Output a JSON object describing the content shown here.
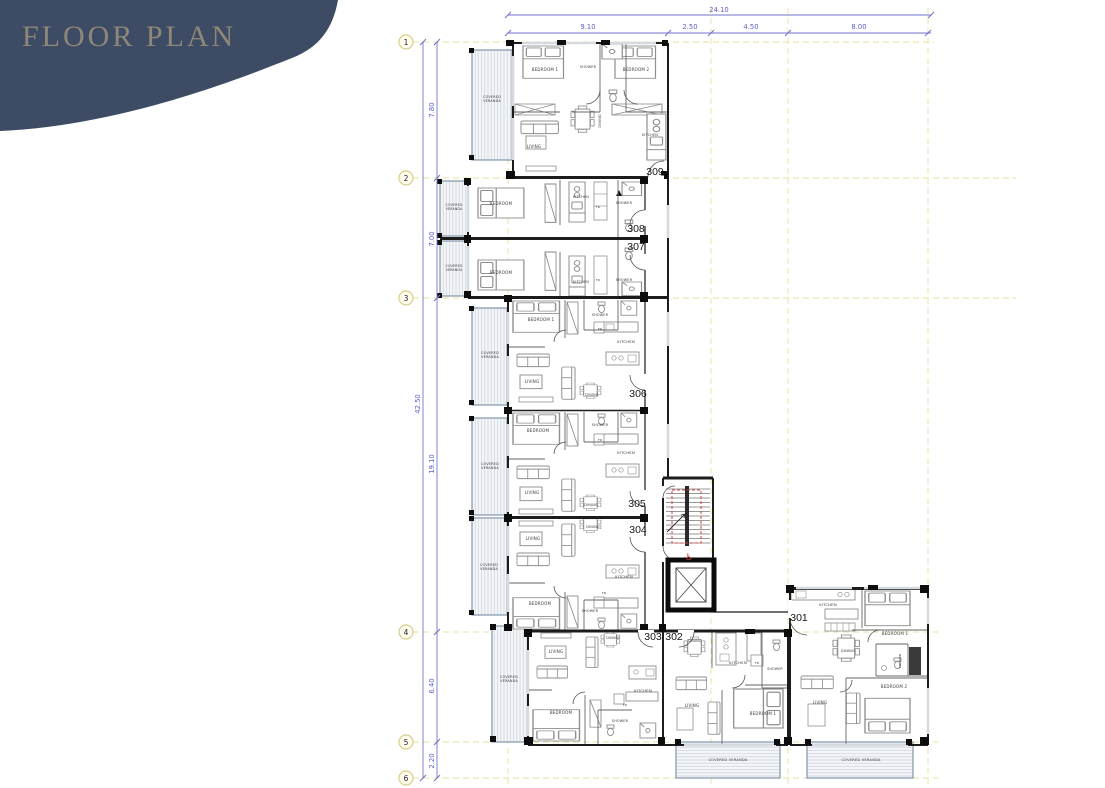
{
  "title": "FLOOR PLAN",
  "colors": {
    "blob": "#3d4c64",
    "title_text": "#8e8779",
    "dimension": "#6a6ac8",
    "grid": "#e7e39b",
    "wall": "#1c1c1c",
    "red_accent": "#c0392b",
    "veranda_border": "#8195aa"
  },
  "plan": {
    "grid_bubbles": [
      {
        "n": "1",
        "y": 42
      },
      {
        "n": "2",
        "y": 178
      },
      {
        "n": "3",
        "y": 298
      },
      {
        "n": "4",
        "y": 632
      },
      {
        "n": "5",
        "y": 742
      },
      {
        "n": "6",
        "y": 778
      }
    ],
    "dim_labels": [
      {
        "t": "24.10",
        "x": 719,
        "y": 12
      },
      {
        "t": "9.10",
        "x": 588,
        "y": 29
      },
      {
        "t": "2.50",
        "x": 690,
        "y": 29
      },
      {
        "t": "4.50",
        "x": 751,
        "y": 29
      },
      {
        "t": "8.00",
        "x": 859,
        "y": 29
      },
      {
        "t": "42.50",
        "x": 420,
        "y": 404,
        "r": -90
      },
      {
        "t": "7.80",
        "x": 434,
        "y": 110,
        "r": -90
      },
      {
        "t": "7.00",
        "x": 434,
        "y": 239,
        "r": -90
      },
      {
        "t": "19.10",
        "x": 434,
        "y": 464,
        "r": -90
      },
      {
        "t": "6.40",
        "x": 434,
        "y": 686,
        "r": -90
      },
      {
        "t": "2.20",
        "x": 434,
        "y": 761,
        "r": -90
      }
    ],
    "unit_numbers": [
      {
        "n": "309",
        "x": 655,
        "y": 175
      },
      {
        "n": "308",
        "x": 636,
        "y": 232
      },
      {
        "n": "307",
        "x": 636,
        "y": 250
      },
      {
        "n": "306",
        "x": 638,
        "y": 397
      },
      {
        "n": "305",
        "x": 637,
        "y": 507
      },
      {
        "n": "304",
        "x": 638,
        "y": 533
      },
      {
        "n": "303",
        "x": 653,
        "y": 640
      },
      {
        "n": "302",
        "x": 674,
        "y": 640
      },
      {
        "n": "301",
        "x": 799,
        "y": 621
      }
    ],
    "room_labels": [
      {
        "t": "BEDROOM 1",
        "x": 545,
        "y": 71
      },
      {
        "t": "SHOWER",
        "x": 588,
        "y": 68,
        "s": 3.4
      },
      {
        "t": "BEDROOM 2",
        "x": 636,
        "y": 71
      },
      {
        "t": "COVERED",
        "t2": "VERANDA",
        "x": 492,
        "y": 98,
        "s": 3.4
      },
      {
        "t": "DINING",
        "x": 601,
        "y": 121,
        "r": -90,
        "s": 3.4
      },
      {
        "t": "LIVING",
        "x": 534,
        "y": 148
      },
      {
        "t": "KITCHEN",
        "x": 650,
        "y": 136,
        "s": 3.4
      },
      {
        "t": "COVERED",
        "t2": "VERANDA",
        "x": 454,
        "y": 206,
        "s": 3.2
      },
      {
        "t": "BEDROOM",
        "x": 501,
        "y": 205
      },
      {
        "t": "KITCHEN",
        "x": 581,
        "y": 198,
        "s": 3.4
      },
      {
        "t": "FR",
        "x": 598,
        "y": 208,
        "s": 3
      },
      {
        "t": "SHOWER",
        "x": 624,
        "y": 204,
        "s": 3.4
      },
      {
        "t": "COVERED",
        "t2": "VERANDA",
        "x": 454,
        "y": 267,
        "s": 3.2
      },
      {
        "t": "BEDROOM",
        "x": 501,
        "y": 274
      },
      {
        "t": "KITCHEN",
        "x": 581,
        "y": 283,
        "s": 3.4
      },
      {
        "t": "FR",
        "x": 598,
        "y": 281,
        "s": 3
      },
      {
        "t": "SHOWER",
        "x": 624,
        "y": 281,
        "s": 3.4
      },
      {
        "t": "COVERED",
        "t2": "VERANDA",
        "x": 490,
        "y": 354,
        "s": 3.4
      },
      {
        "t": "BEDROOM 1",
        "x": 541,
        "y": 321
      },
      {
        "t": "SHOWER",
        "x": 600,
        "y": 316,
        "s": 3.4
      },
      {
        "t": "FR",
        "x": 600,
        "y": 330,
        "s": 3
      },
      {
        "t": "KITCHEN",
        "x": 626,
        "y": 343,
        "s": 3.8
      },
      {
        "t": "LIVING",
        "x": 532,
        "y": 383
      },
      {
        "t": "DINING",
        "x": 592,
        "y": 396,
        "s": 3.4
      },
      {
        "t": "COVERED",
        "t2": "VERANDA",
        "x": 490,
        "y": 465,
        "s": 3.4
      },
      {
        "t": "BEDROOM",
        "x": 538,
        "y": 432
      },
      {
        "t": "SHOWER",
        "x": 600,
        "y": 426,
        "s": 3.4
      },
      {
        "t": "FR",
        "x": 600,
        "y": 441,
        "s": 3
      },
      {
        "t": "KITCHEN",
        "x": 626,
        "y": 454,
        "s": 3.8
      },
      {
        "t": "LIVING",
        "x": 532,
        "y": 494
      },
      {
        "t": "DINING",
        "x": 591,
        "y": 506,
        "s": 3.4
      },
      {
        "t": "COVERED",
        "t2": "VERANDA",
        "x": 489,
        "y": 566,
        "s": 3.4
      },
      {
        "t": "DINING",
        "x": 593,
        "y": 528,
        "s": 3.4
      },
      {
        "t": "LIVING",
        "x": 533,
        "y": 540
      },
      {
        "t": "KITCHEN",
        "x": 624,
        "y": 578,
        "s": 3.8
      },
      {
        "t": "FR",
        "x": 604,
        "y": 594,
        "s": 3
      },
      {
        "t": "BEDROOM",
        "x": 540,
        "y": 605
      },
      {
        "t": "SHOWER",
        "x": 590,
        "y": 612,
        "s": 3.4
      },
      {
        "t": "COVERED",
        "t2": "VERANDA",
        "x": 509,
        "y": 678,
        "s": 3.4
      },
      {
        "t": "LIVING",
        "x": 556,
        "y": 653
      },
      {
        "t": "DINING",
        "x": 613,
        "y": 639,
        "s": 3.4
      },
      {
        "t": "KITCHEN",
        "x": 643,
        "y": 692,
        "s": 3.8
      },
      {
        "t": "FR",
        "x": 625,
        "y": 706,
        "s": 3
      },
      {
        "t": "BEDROOM",
        "x": 561,
        "y": 714
      },
      {
        "t": "SHOWER",
        "x": 620,
        "y": 722,
        "s": 3.4
      },
      {
        "t": "DINING",
        "x": 695,
        "y": 642,
        "s": 3.4
      },
      {
        "t": "KITCHEN",
        "x": 738,
        "y": 664,
        "s": 3.8
      },
      {
        "t": "FR",
        "x": 757,
        "y": 664,
        "s": 3
      },
      {
        "t": "SHOWER",
        "x": 775,
        "y": 670,
        "s": 3.2
      },
      {
        "t": "LIVING",
        "x": 692,
        "y": 707
      },
      {
        "t": "BEDROOM 1",
        "x": 763,
        "y": 715
      },
      {
        "t": "COVERED VERANDA",
        "x": 728,
        "y": 761,
        "s": 3.6
      },
      {
        "t": "KITCHEN",
        "x": 828,
        "y": 606,
        "s": 3.8
      },
      {
        "t": "BEDROOM 1",
        "x": 895,
        "y": 635
      },
      {
        "t": "DINING",
        "x": 848,
        "y": 652,
        "s": 3.6
      },
      {
        "t": "SHOWER",
        "x": 901,
        "y": 661,
        "s": 3,
        "r": -90
      },
      {
        "t": "BEDROOM 2",
        "x": 894,
        "y": 688
      },
      {
        "t": "LIVING",
        "x": 820,
        "y": 704
      },
      {
        "t": "COVERED VERANDA",
        "x": 861,
        "y": 761,
        "s": 3.6
      }
    ],
    "icons": [
      {
        "t": "♿",
        "x": 689,
        "y": 560,
        "s": 9,
        "name": "wheelchair-accessible-icon"
      }
    ]
  }
}
